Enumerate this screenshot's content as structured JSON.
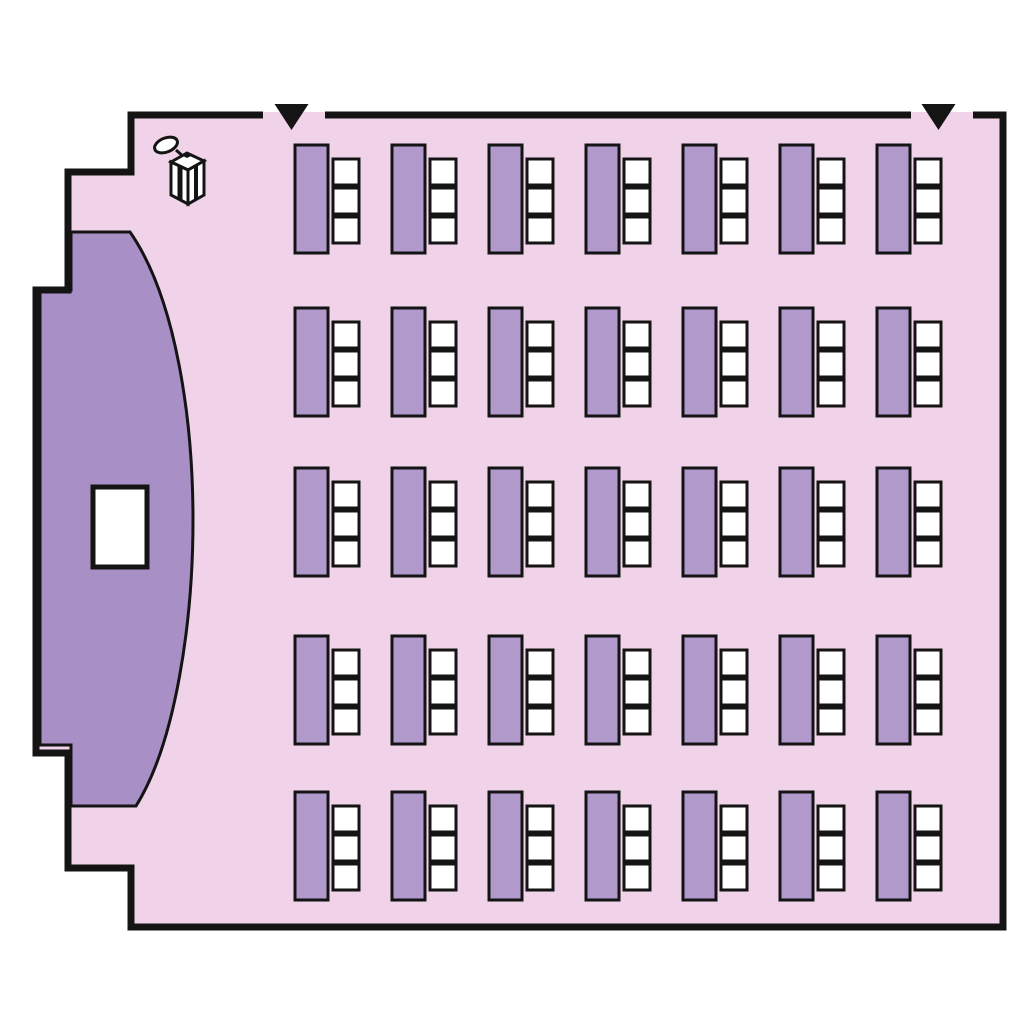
{
  "diagram_type": "room-floor-plan-seating-chart",
  "colors": {
    "background": "#ffffff",
    "floor": "#f0d3e9",
    "stage": "#a88fc6",
    "furniture": "#b199cc",
    "chair": "#ffffff",
    "wall": "#141414"
  },
  "room": {
    "doors": [
      {
        "id": "left-entrance",
        "marker": "down-triangle",
        "cx": 291.5,
        "gap_from": 263,
        "gap_to": 325
      },
      {
        "id": "right-entrance",
        "marker": "down-triangle",
        "cx": 938.5,
        "gap_from": 911,
        "gap_to": 973
      }
    ],
    "stage": {
      "present": true,
      "shape": "half-ellipse-alcove"
    },
    "screen": {
      "present": true,
      "x": 93,
      "y": 487,
      "w": 54,
      "h": 80
    },
    "lectern": {
      "present": true,
      "icon": "lectern-with-microphone"
    }
  },
  "seating": {
    "rows": 5,
    "columns": 7,
    "chairs_per_table": 3,
    "total_tables": 35,
    "total_chairs": 105,
    "row_y": [
      145,
      308,
      468,
      636,
      792
    ],
    "col_x": [
      295,
      392,
      489,
      586,
      683,
      780,
      877
    ],
    "table_w": 33,
    "table_h": 108,
    "chair_size": 26,
    "chair_gap": 3,
    "chair_dx": 38,
    "chair_dy": 14
  }
}
